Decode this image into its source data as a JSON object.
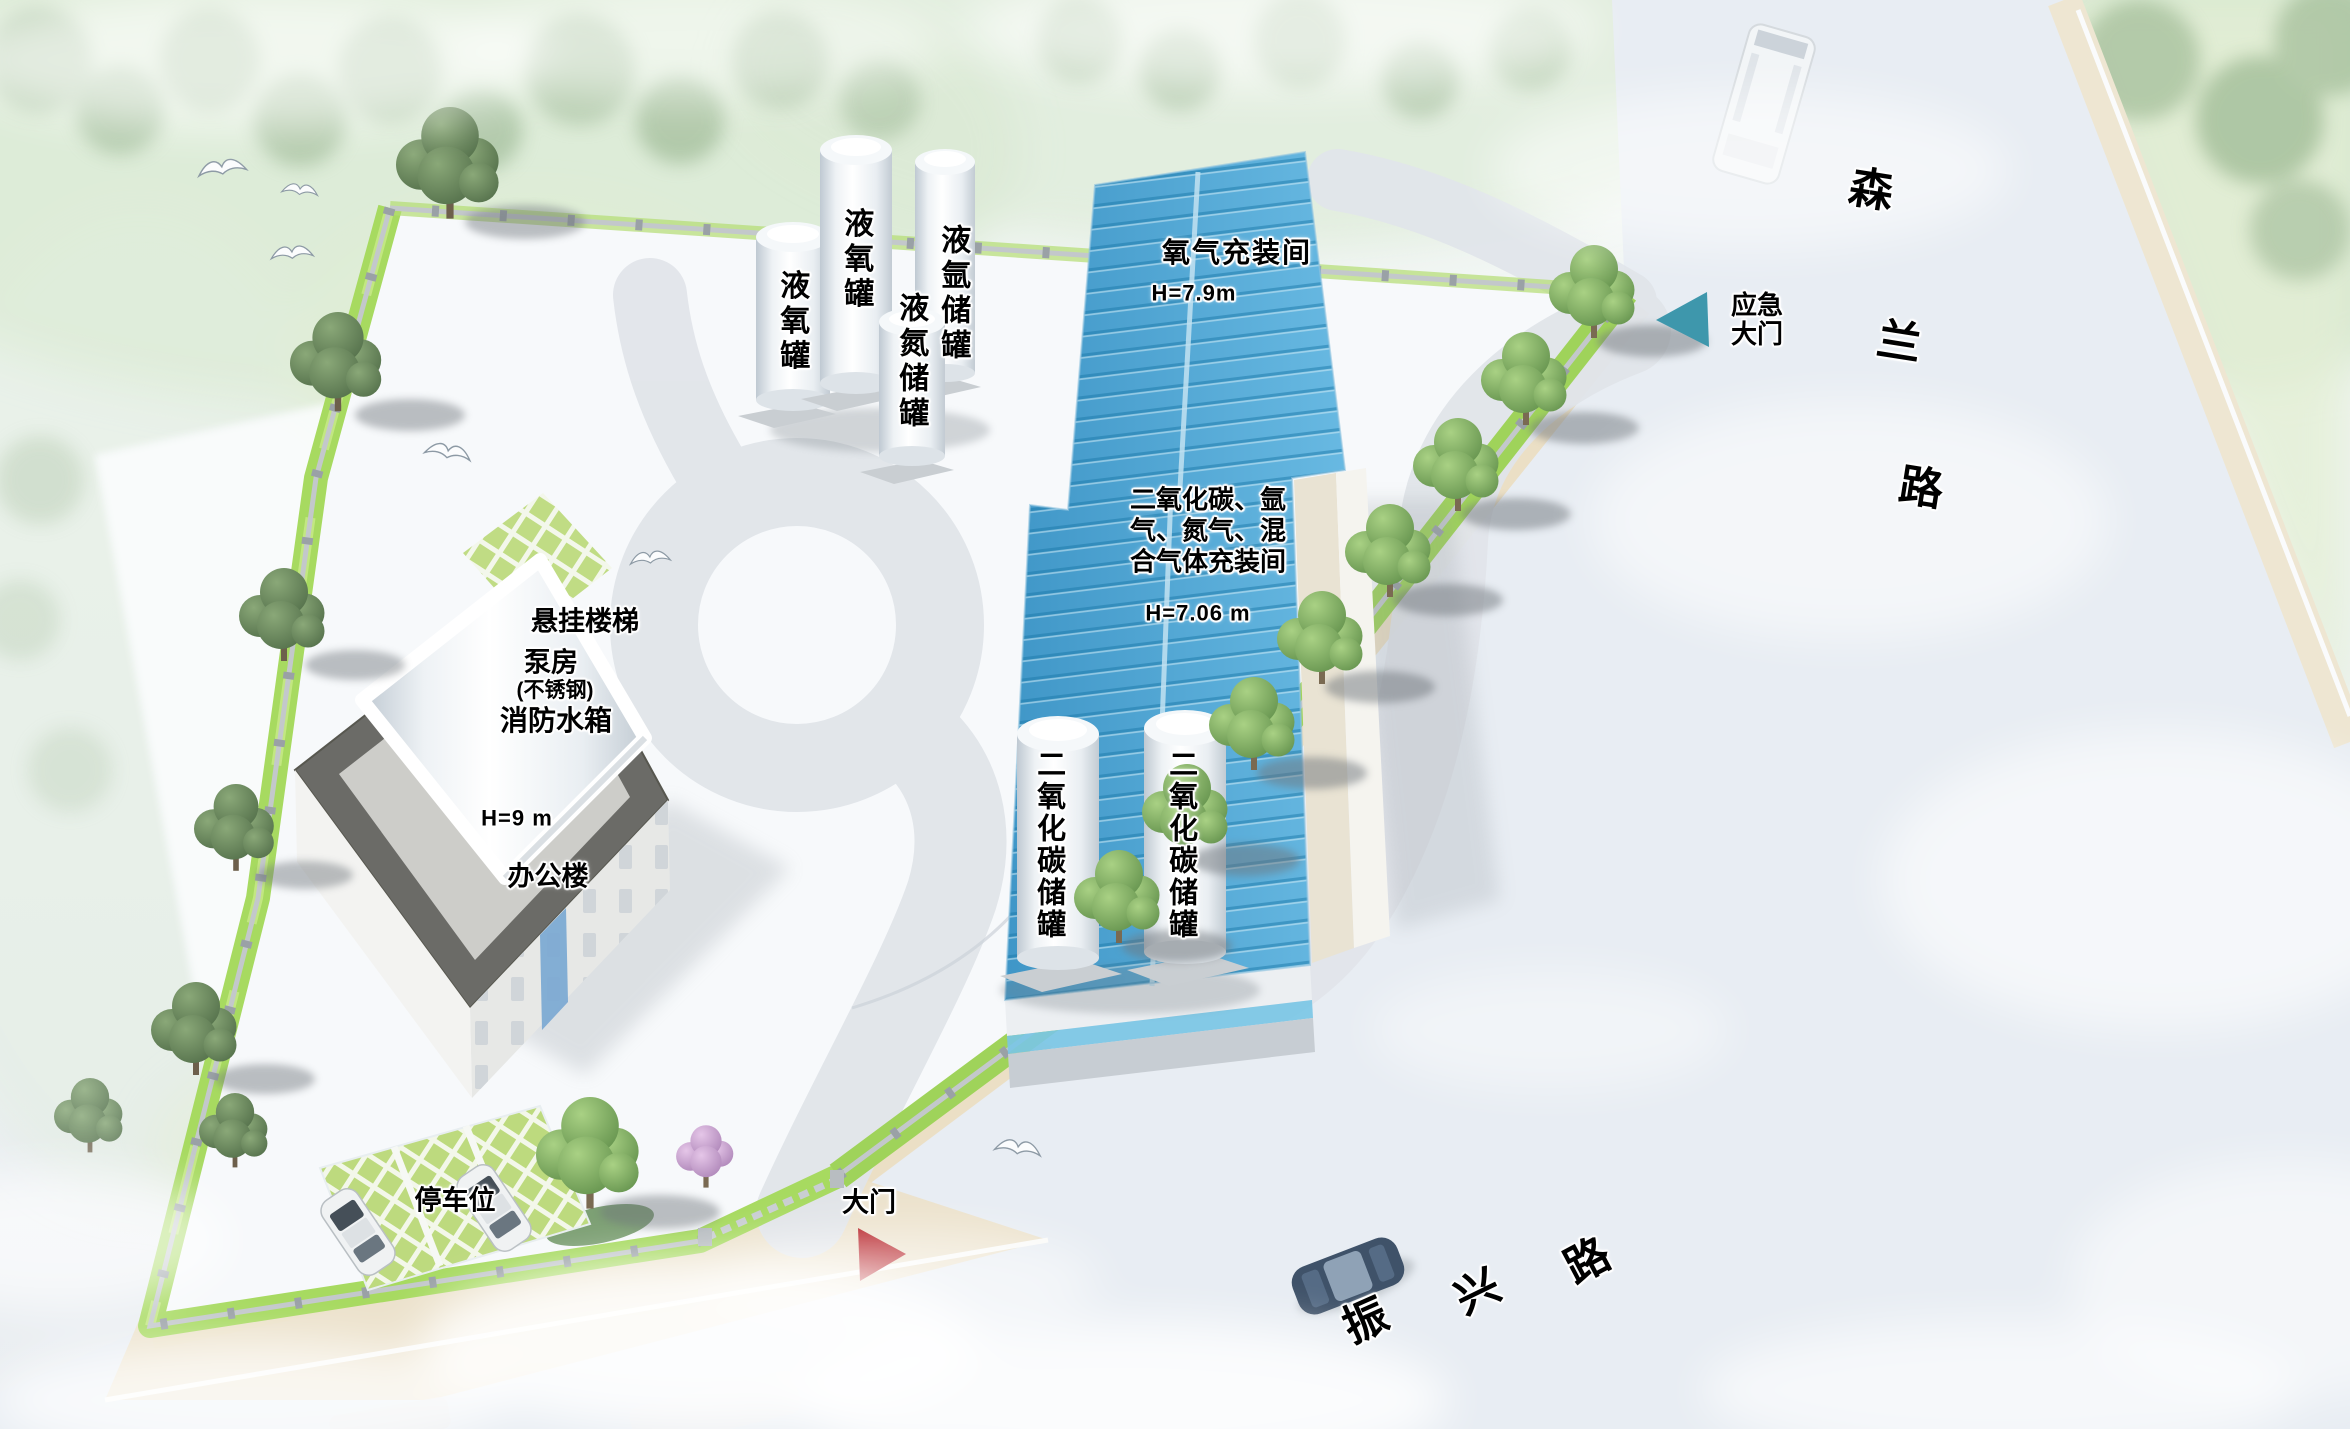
{
  "labels": {
    "lox_tank_a": "液氧罐",
    "lox_tank_b": "液氧罐",
    "argon_tank": "液氩储罐",
    "nitrogen_tank": "液氮储罐",
    "oxygen_room": "氧气充装间",
    "oxygen_room_height": "H=7.9m",
    "mixed_room_line1": "二氧化碳、氩",
    "mixed_room_line2": "气、氮气、混",
    "mixed_room_line3": "合气体充装间",
    "mixed_room_height": "H=7.06 m",
    "co2_tank_a": "二氧化碳储罐",
    "co2_tank_b": "二氧化碳储罐",
    "hanging_stairs": "悬挂楼梯",
    "pump_room": "泵房",
    "stainless_steel": "(不锈钢)",
    "fire_water_tank": "消防水箱",
    "office_height": "H=9 m",
    "office_building": "办公楼",
    "parking_space": "停车位",
    "main_gate": "大门",
    "emergency_gate_line1": "应急",
    "emergency_gate_line2": "大门"
  },
  "roads": {
    "senlan": {
      "name": "森兰路",
      "chars": [
        "森",
        "兰",
        "路"
      ]
    },
    "zhenxing": {
      "name": "振兴路",
      "chars": [
        "振",
        "兴",
        "路"
      ]
    }
  },
  "colors": {
    "roof_blue": "#4ba5d3",
    "main_gate_arrow": "#b11117",
    "emergency_gate_arrow": "#3e97ac"
  }
}
